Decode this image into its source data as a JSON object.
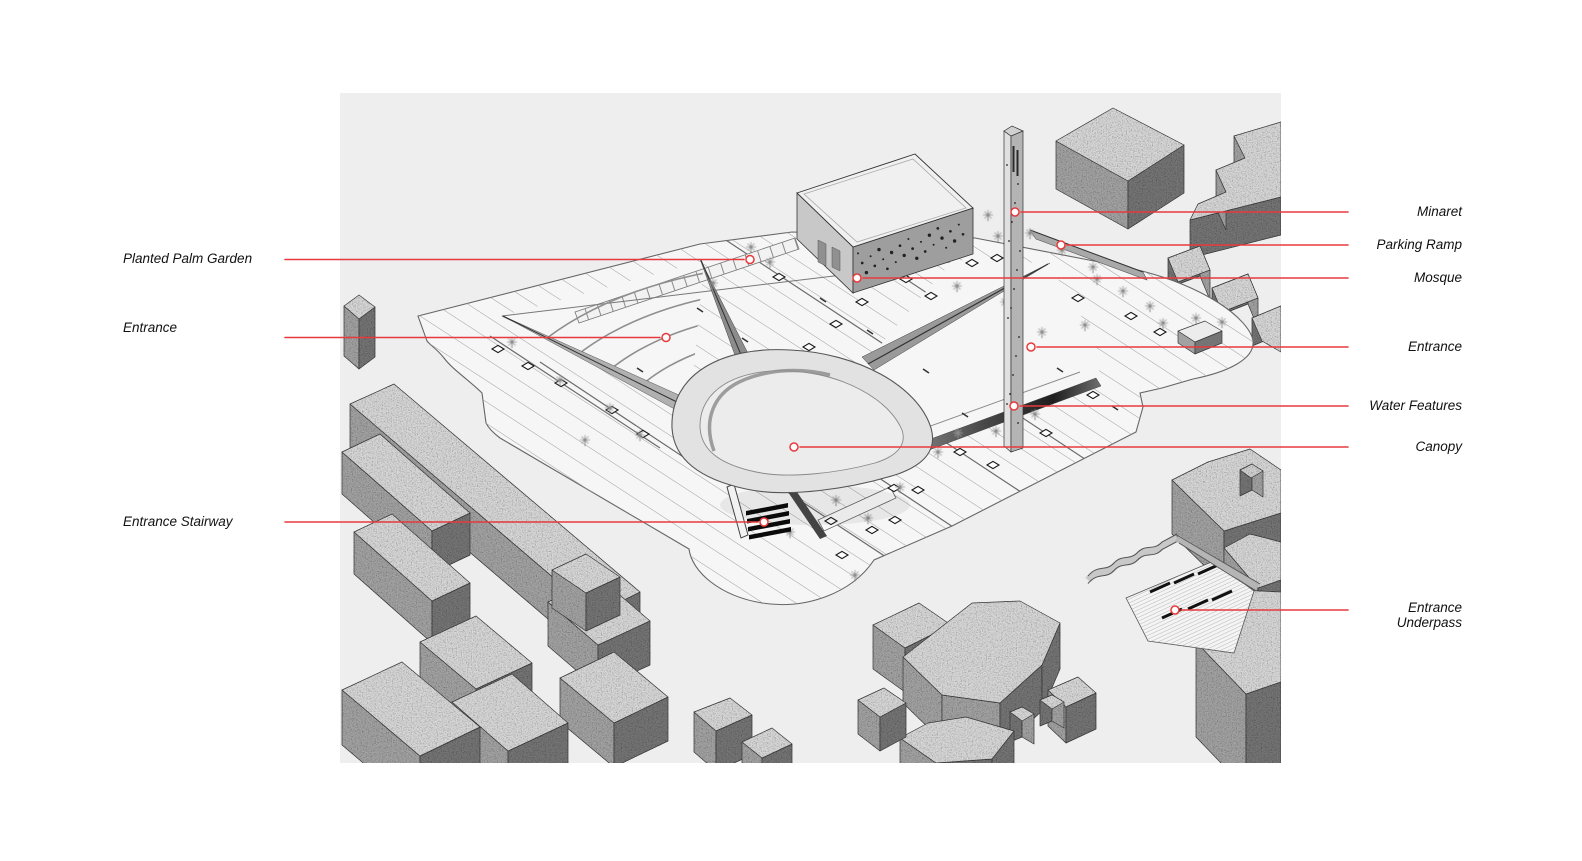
{
  "callouts": {
    "left": [
      {
        "label": "Planted Palm Garden"
      },
      {
        "label": "Entrance"
      },
      {
        "label": "Entrance Stairway"
      }
    ],
    "right": [
      {
        "label": "Minaret"
      },
      {
        "label": "Parking Ramp"
      },
      {
        "label": "Mosque"
      },
      {
        "label": "Entrance"
      },
      {
        "label": "Water Features"
      },
      {
        "label": "Canopy"
      },
      {
        "label": "Entrance Underpass"
      }
    ]
  },
  "colors": {
    "leader_red": "#e8393c",
    "canvas_bg": "#eeeeee",
    "page_bg": "#ffffff",
    "label_text": "#111111"
  }
}
